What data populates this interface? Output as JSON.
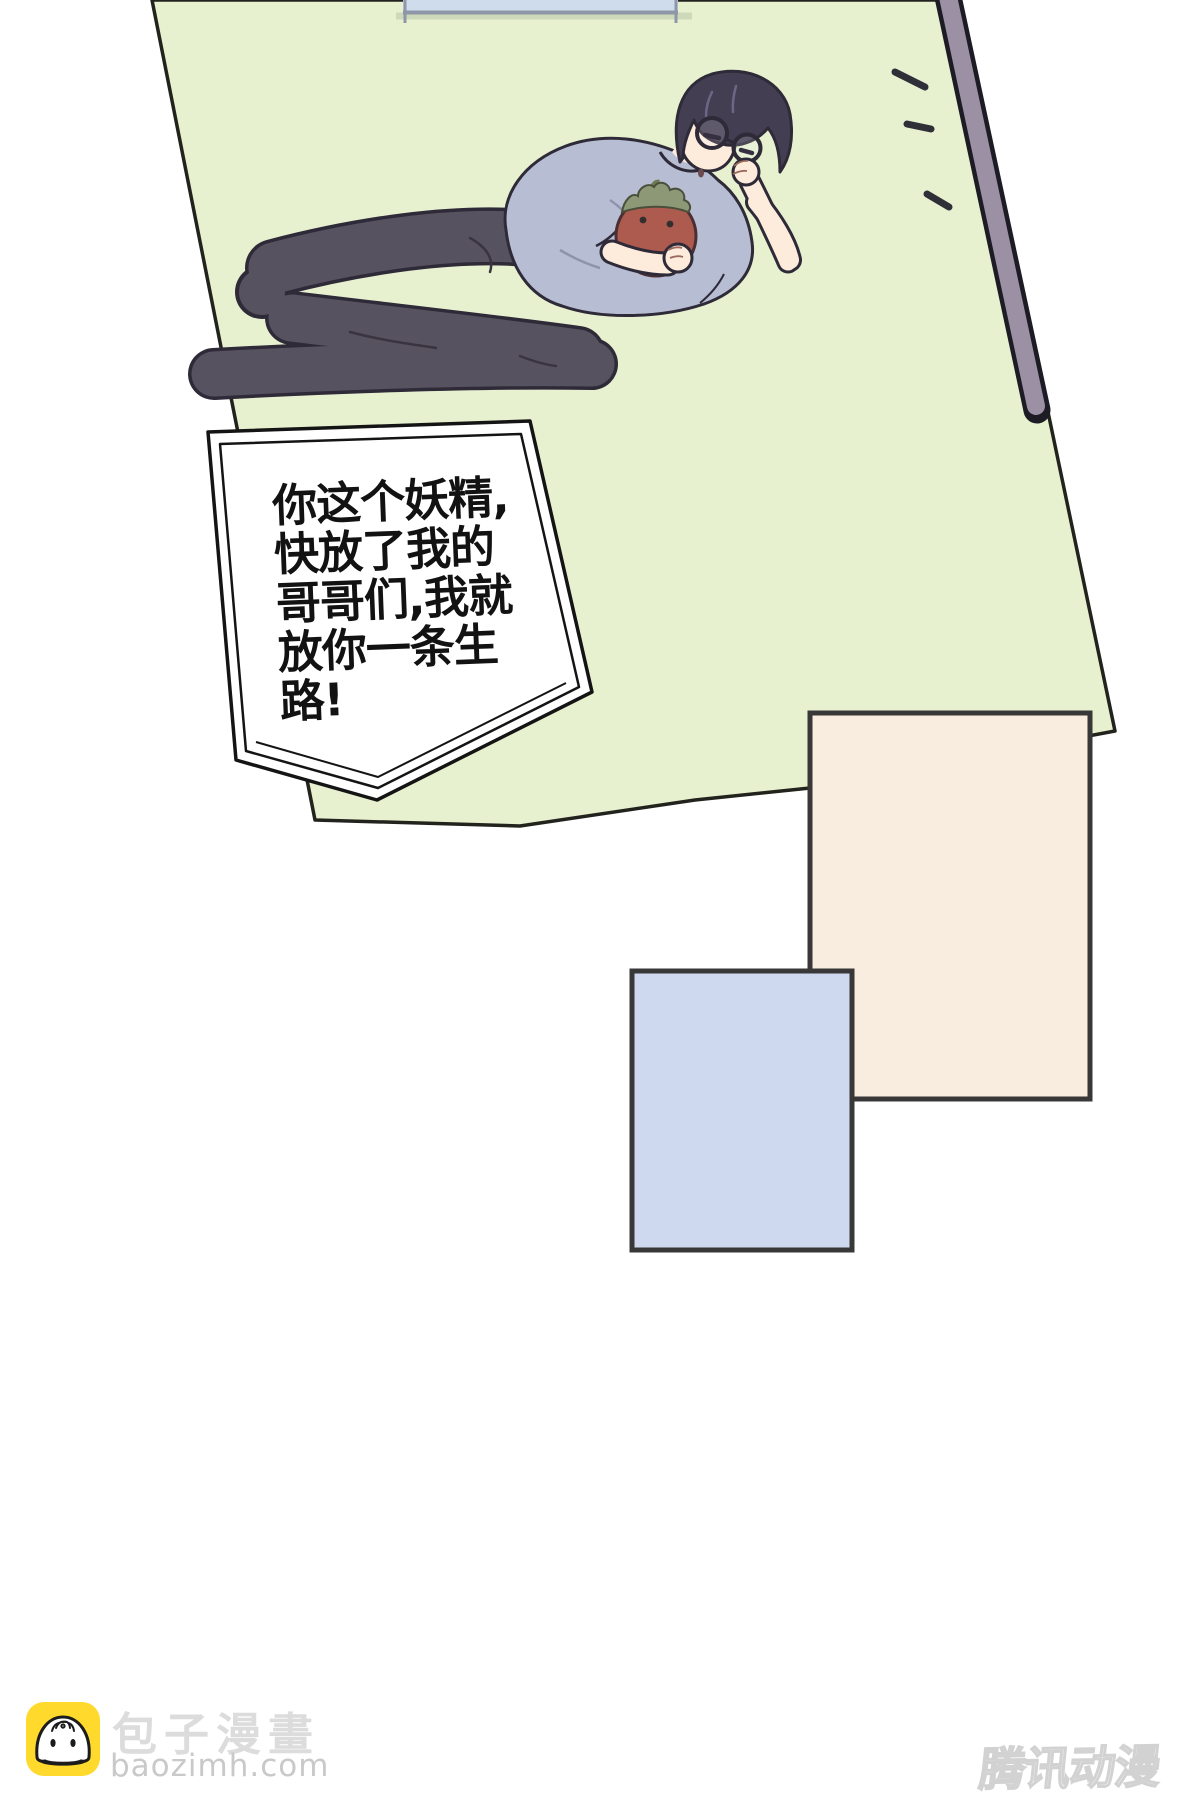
{
  "page": {
    "background": "#ffffff"
  },
  "panel": {
    "fill": "#e7f1d0",
    "edge": "#23231e",
    "strip_fill": "#9b90a4",
    "strip_edge": "#1d1c24",
    "window_fill": "#cfdcec",
    "window_edge": "#8d97a7"
  },
  "bubble": {
    "fill": "#ffffff",
    "border": "#141414",
    "lines": [
      "你这个妖精,",
      "快放了我的",
      "哥哥们,我就",
      "放你一条生",
      "路!"
    ]
  },
  "character": {
    "hair": "#433e52",
    "hair_highlight": "#6c6786",
    "skin": "#fdecdc",
    "shirt": "#b7bdd3",
    "pants": "#57525f",
    "outline": "#2e2a38",
    "plush_body": "#ad5a4f",
    "plush_leaf": "#8d9877"
  },
  "inset_panels": {
    "cream_fill": "#f8edde",
    "blue_fill": "#ced8ee",
    "border": "#383838"
  },
  "footer": {
    "site_name": "包子漫畫",
    "site_url": "baozimh.com",
    "logo_bg": "#ffd92b"
  },
  "watermark": {
    "text": "腾讯动漫",
    "color": "#d2d2d2"
  }
}
